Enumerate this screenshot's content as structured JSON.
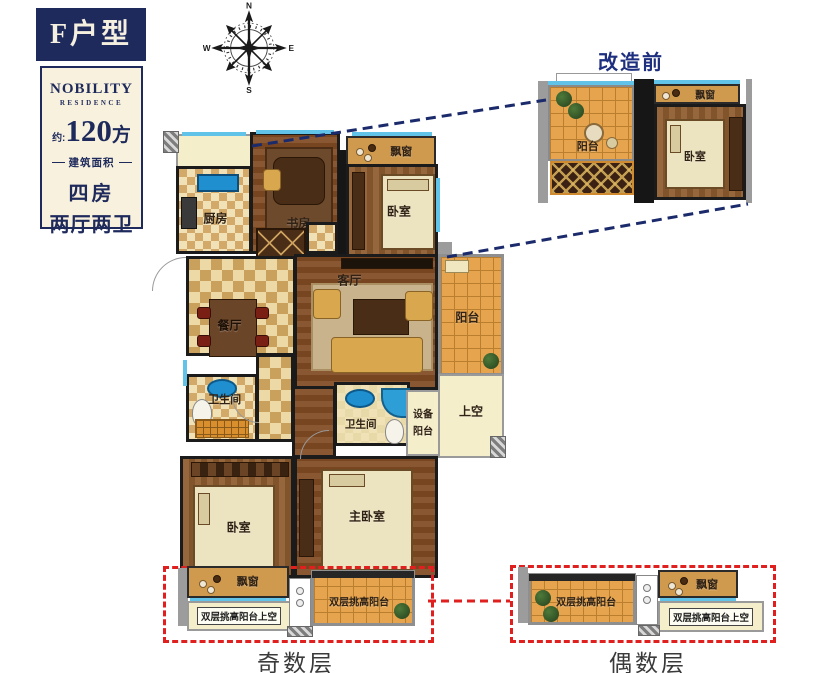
{
  "panel": {
    "unit": "F户型",
    "brand": "NOBILITY",
    "brand_sub": "RESIDENCE",
    "area_prefix": "约:",
    "area_value": "120",
    "area_unit": "方",
    "area_label": "建筑面积",
    "layout_1": "四房",
    "layout_2": "两厅两卫"
  },
  "compass": {
    "n": "N",
    "e": "E",
    "s": "S",
    "w": "W"
  },
  "inset": {
    "title": "改造前",
    "balcony": "阳台",
    "bay_window": "飘窗",
    "bedroom": "卧室"
  },
  "plan": {
    "kitchen": "厨房",
    "study": "书房",
    "bedroom_top": "卧室",
    "bay_window_top": "飘窗",
    "dining": "餐厅",
    "living": "客厅",
    "balcony": "阳台",
    "bath_left": "卫生间",
    "bath_mid": "卫生间",
    "equip_l1": "设备",
    "equip_l2": "阳台",
    "void": "上空",
    "bedroom_left": "卧室",
    "master_bedroom": "主卧室"
  },
  "odd": {
    "label": "奇数层",
    "bay_window": "飘窗",
    "void": "双层挑高阳台上空",
    "balcony": "双层挑高阳台"
  },
  "even": {
    "label": "偶数层",
    "bay_window": "飘窗",
    "void": "双层挑高阳台上空",
    "balcony": "双层挑高阳台"
  },
  "icons": {
    "compass-icon": "compass-rose",
    "plant-icon": "potted-plant"
  },
  "colors": {
    "navy": "#1e2a5c",
    "panel_cream": "#f8f1dd",
    "red_dashed": "#e01f1f",
    "blue_dashed": "#1b2a6b",
    "window_blue": "#62c3e8",
    "balcony_tile": "#e6a44e",
    "diamond_tile": "#c9a05c",
    "wood": "#8a5733"
  }
}
